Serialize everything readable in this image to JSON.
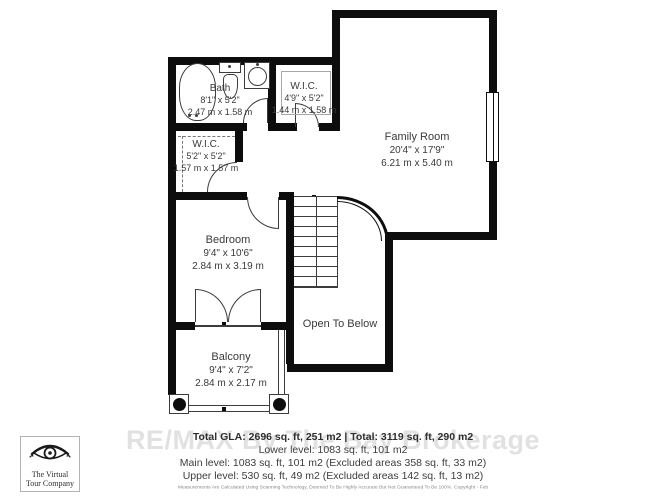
{
  "colors": {
    "wall": "#0d0d0d",
    "line": "#3c3c3c",
    "text": "#3a3a3a",
    "watermark": "#c9c9c9"
  },
  "rooms": {
    "bath": {
      "name": "Bath",
      "ft": "8'1\" x 5'2\"",
      "m": "2.47 m x 1.58 m"
    },
    "wic1": {
      "name": "W.I.C.",
      "ft": "4'9\" x 5'2\"",
      "m": "1.44 m x 1.58 m"
    },
    "wic2": {
      "name": "W.I.C.",
      "ft": "5'2\" x 5'2\"",
      "m": "1.57 m x 1.57 m"
    },
    "family_room": {
      "name": "Family Room",
      "ft": "20'4\" x 17'9\"",
      "m": "6.21 m x 5.40 m"
    },
    "bedroom": {
      "name": "Bedroom",
      "ft": "9'4\" x 10'6\"",
      "m": "2.84 m x 3.19 m"
    },
    "open_to_below": {
      "name": "Open To Below"
    },
    "balcony": {
      "name": "Balcony",
      "ft": "9'4\" x 7'2\"",
      "m": "2.84 m x 2.17 m"
    }
  },
  "footer": {
    "total": "Total GLA: 2696 sq. ft, 251 m2 | Total: 3119 sq. ft, 290 m2",
    "lower": "Lower level: 1083 sq. ft, 101 m2",
    "main": "Main level: 1083 sq. ft, 101 m2 (Excluded areas 358 sq. ft, 33 m2)",
    "upper": "Upper level: 530 sq. ft, 49 m2 (Excluded areas 142 sq. ft, 13 m2)",
    "disclaimer": "Measurements Are Calculated Using Scanning Technology, Deemed To Be Highly Accurate But Not Guaranteed To Be 100%. Copyright - Feb"
  },
  "watermark": "RE/MAX By The Bay Brokerage",
  "logo": {
    "icon": "eye-icon",
    "line1": "The Virtual",
    "line2": "Tour Company"
  }
}
